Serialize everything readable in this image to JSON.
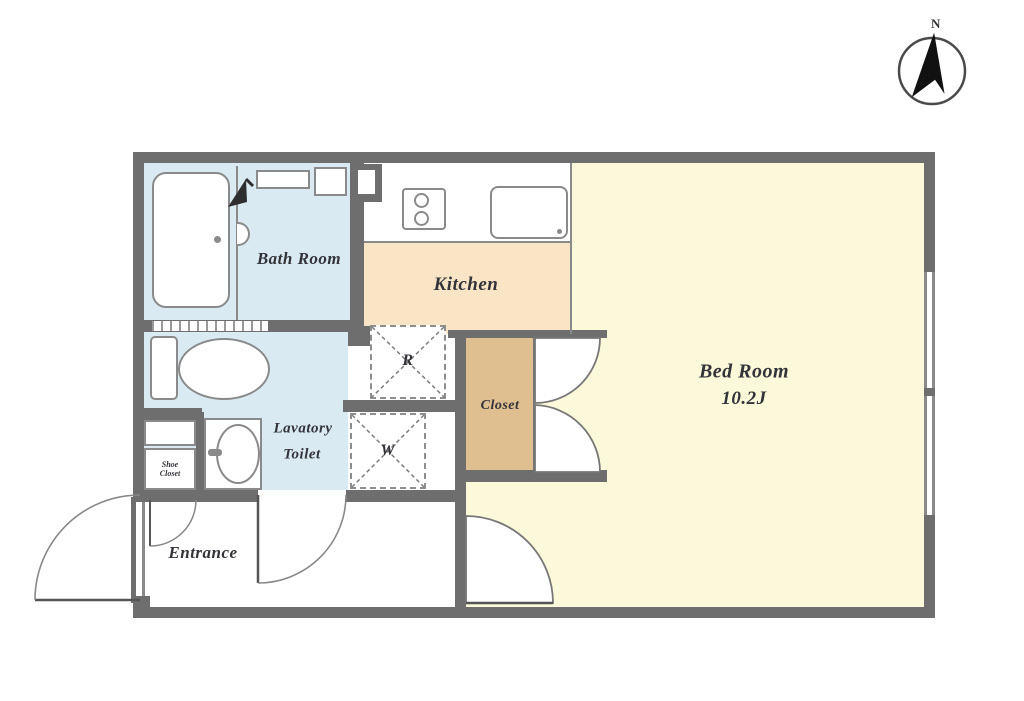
{
  "compass": {
    "north_label": "N"
  },
  "rooms": {
    "bath": {
      "label": "Bath Room"
    },
    "kitchen": {
      "label": "Kitchen"
    },
    "bedroom": {
      "label": "Bed Room",
      "size": "10.2J"
    },
    "closet": {
      "label": "Closet"
    },
    "lavatory": {
      "label_line1": "Lavatory",
      "label_line2": "Toilet"
    },
    "entrance": {
      "label": "Entrance"
    },
    "shoe_closet": {
      "label_line1": "Shoe",
      "label_line2": "Closet"
    },
    "refrigerator_space": {
      "label": "R"
    },
    "washer_space": {
      "label": "W"
    }
  },
  "colors": {
    "wall": "#6e6e6e",
    "water_room": "#daeaf2",
    "kitchen_floor": "#f9e5c6",
    "bedroom_floor": "#fbf9da",
    "closet_fill": "#dfbf90",
    "line": "#8a8a8a",
    "text": "#33333a"
  }
}
